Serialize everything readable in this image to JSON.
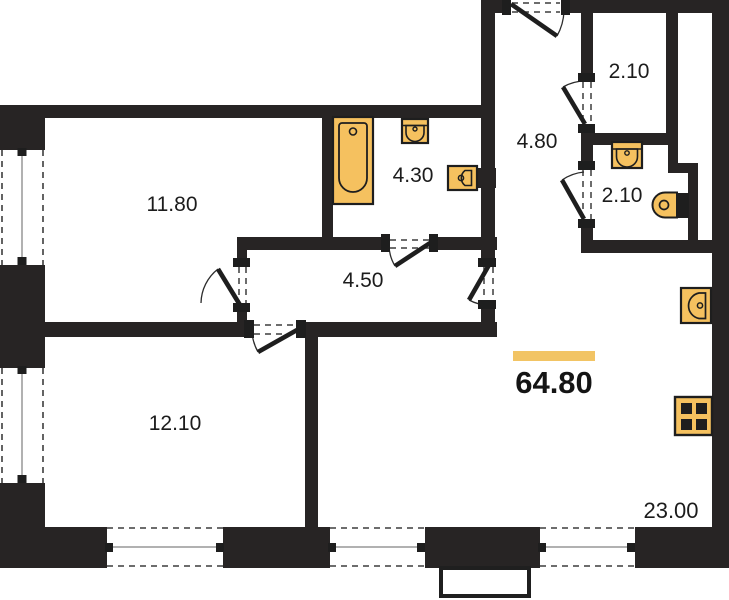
{
  "plan": {
    "total_area": "64.80",
    "rooms": [
      {
        "name": "bedroom-top-left",
        "area": "11.80"
      },
      {
        "name": "bedroom-bottom-left",
        "area": "12.10"
      },
      {
        "name": "hallway",
        "area": "4.50"
      },
      {
        "name": "bathroom",
        "area": "4.30"
      },
      {
        "name": "entry-hall",
        "area": "4.80"
      },
      {
        "name": "wardrobe",
        "area": "2.10"
      },
      {
        "name": "wc",
        "area": "2.10"
      },
      {
        "name": "kitchen-living-room",
        "area": "23.00"
      }
    ],
    "fixtures": [
      "bathtub-icon",
      "washbasin-icon",
      "washbasin-icon",
      "toilet-icon",
      "kitchen-sink-icon",
      "stove-icon"
    ],
    "colors": {
      "accent_highlight": "#F2C464",
      "wall": "#272424",
      "fixture_fill": "#F5C15F",
      "label_text": "#1C1C1C"
    }
  }
}
